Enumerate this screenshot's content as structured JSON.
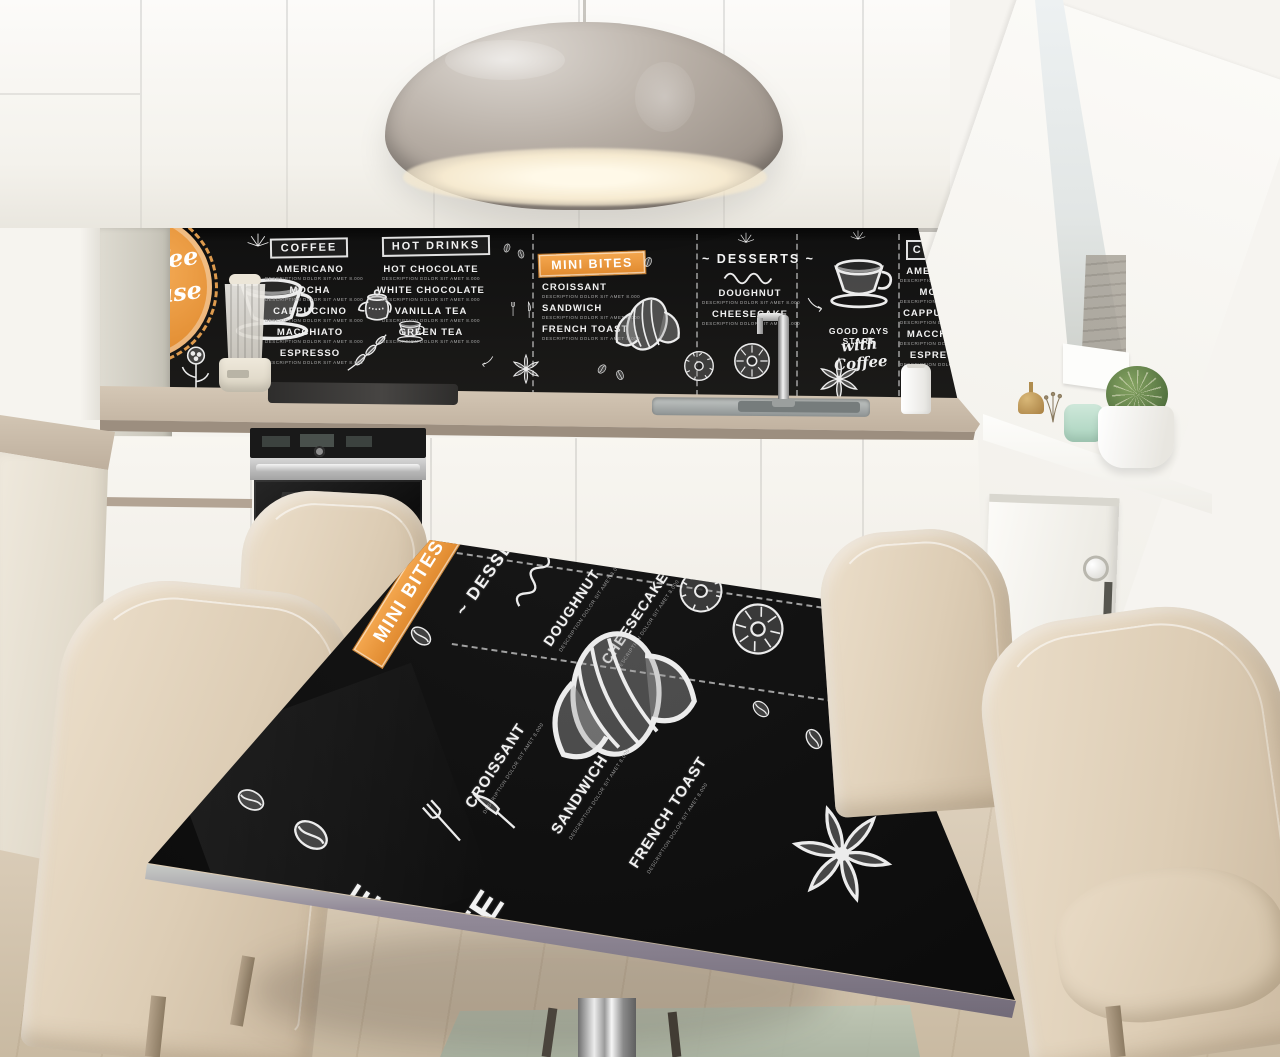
{
  "scene": {
    "description": "Modern white attic kitchen; chalkboard coffee-menu backsplash and matching black menu-print dining table with beige leather chairs"
  },
  "colors": {
    "accent_orange": "#ED9B40",
    "board_black": "#141414",
    "chalk_white": "#F2F2F2",
    "counter_taupe": "#C3B4A2",
    "cabinet_white": "#F6F4EF",
    "chair_beige": "#E0D2BD",
    "floor_wood": "#D9CCBA",
    "lamp_grey": "#A79E95",
    "steel_grey": "#B9BCBB"
  },
  "menu": {
    "badge": {
      "line1": "Coffee",
      "line2": "House"
    },
    "note": "DESCRIPTION DOLOR SIT AMET 8.000",
    "coffee": {
      "title": "COFFEE",
      "items": [
        "AMERICANO",
        "MOCHA",
        "CAPPUCCINO",
        "MACCHIATO",
        "ESPRESSO"
      ]
    },
    "hot_drinks": {
      "title": "HOT DRINKS",
      "items": [
        "HOT CHOCOLATE",
        "WHITE CHOCOLATE",
        "VANILLA TEA",
        "GREEN TEA"
      ]
    },
    "mini_bites": {
      "title": "MINI BITES",
      "items": [
        "CROISSANT",
        "SANDWICH",
        "FRENCH TOAST"
      ]
    },
    "desserts": {
      "title": "DESSERTS",
      "flourish": "~",
      "items": [
        "DOUGHNUT",
        "CHEESECAKE"
      ],
      "tagline_line1": "GOOD DAYS START",
      "tagline_line2": "with Coffee"
    }
  },
  "table_print": {
    "partial_letters": [
      "E",
      "TE"
    ]
  }
}
